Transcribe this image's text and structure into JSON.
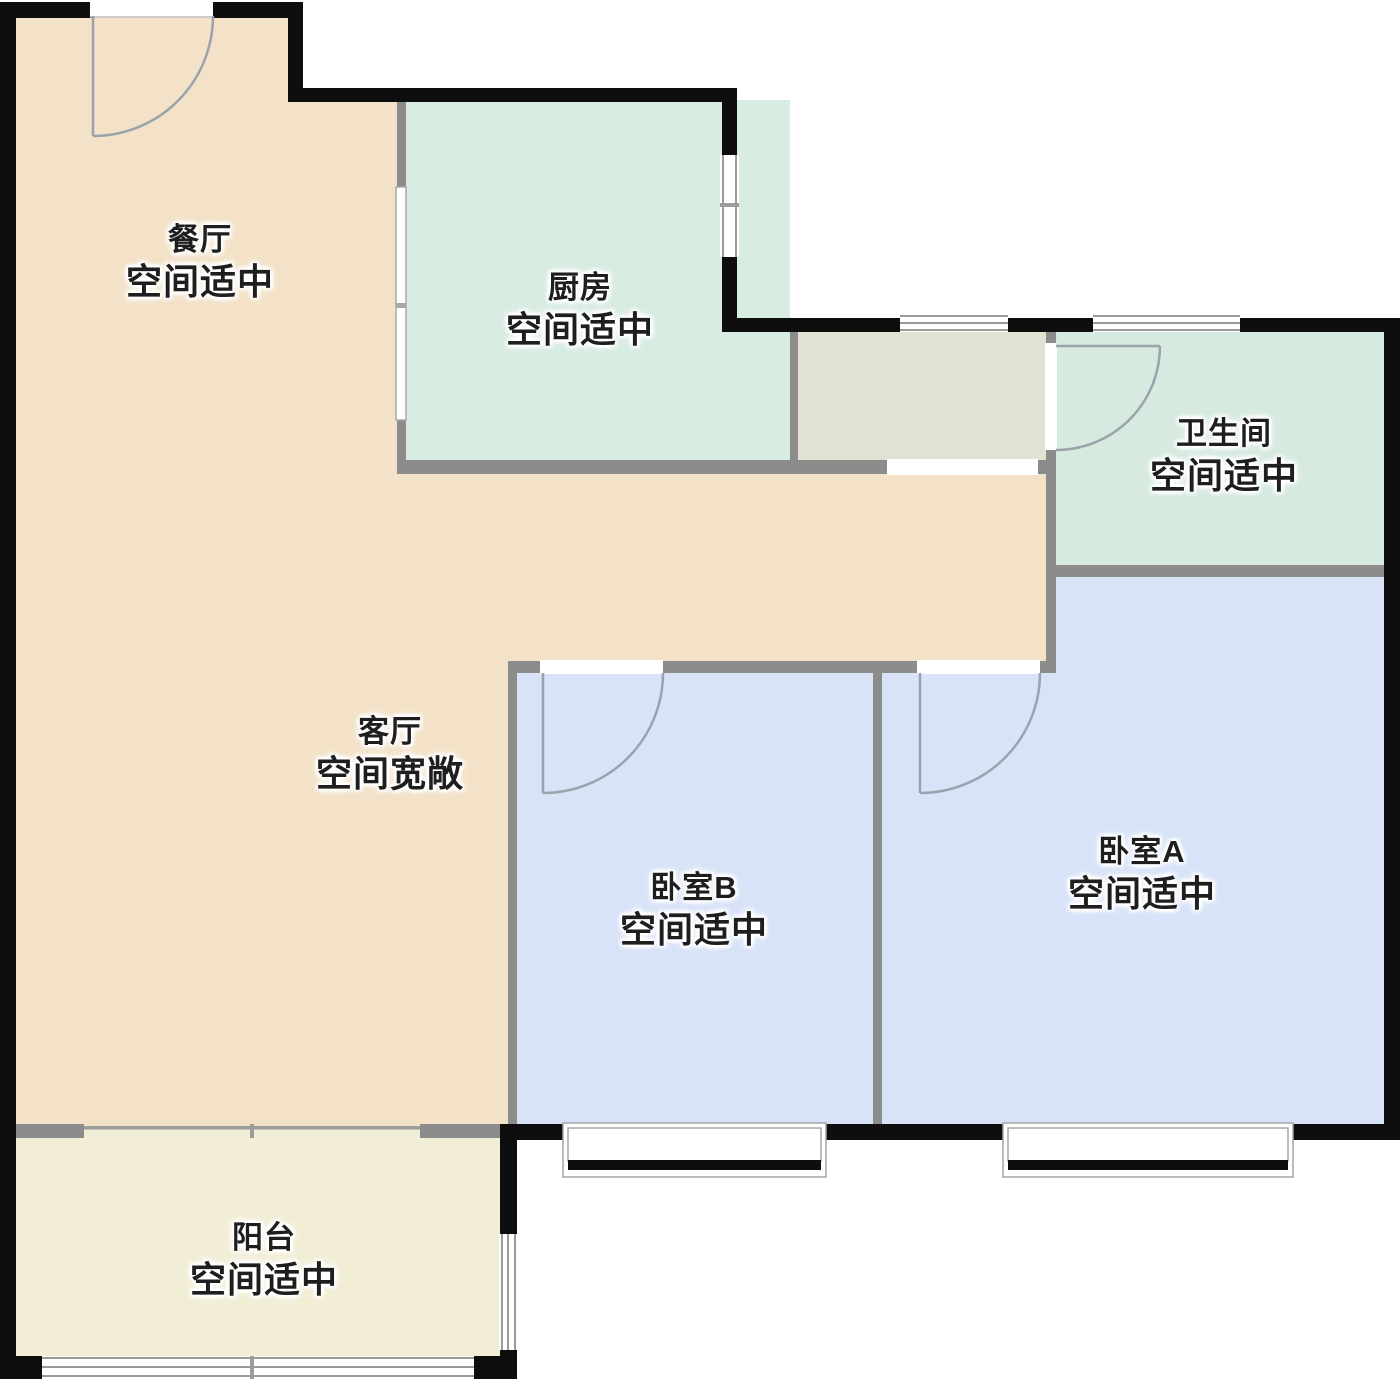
{
  "plan_type": "apartment-floor-plan",
  "rooms": [
    {
      "name": "餐厅",
      "note": "空间适中"
    },
    {
      "name": "厨房",
      "note": "空间适中"
    },
    {
      "name": "卫生间",
      "note": "空间适中"
    },
    {
      "name": "客厅",
      "note": "空间宽敞"
    },
    {
      "name": "卧室B",
      "note": "空间适中"
    },
    {
      "name": "卧室A",
      "note": "空间适中"
    },
    {
      "name": "阳台",
      "note": "空间适中"
    }
  ],
  "palette": {
    "living_dining": "#f3e2c7",
    "kitchen": "#d8ece2",
    "bathroom": "#d6eae0",
    "bedroom": "#d8e3f8",
    "balcony": "#f2eed6",
    "entry": "#e0e3d2",
    "exterior_wall": "#0e0e0e",
    "interior_wall": "#8c8c8c",
    "window_line": "#9b9b9b",
    "door_arc": "#9aa2ab",
    "label_text": "#1e1e1e",
    "background": "#ffffff"
  }
}
